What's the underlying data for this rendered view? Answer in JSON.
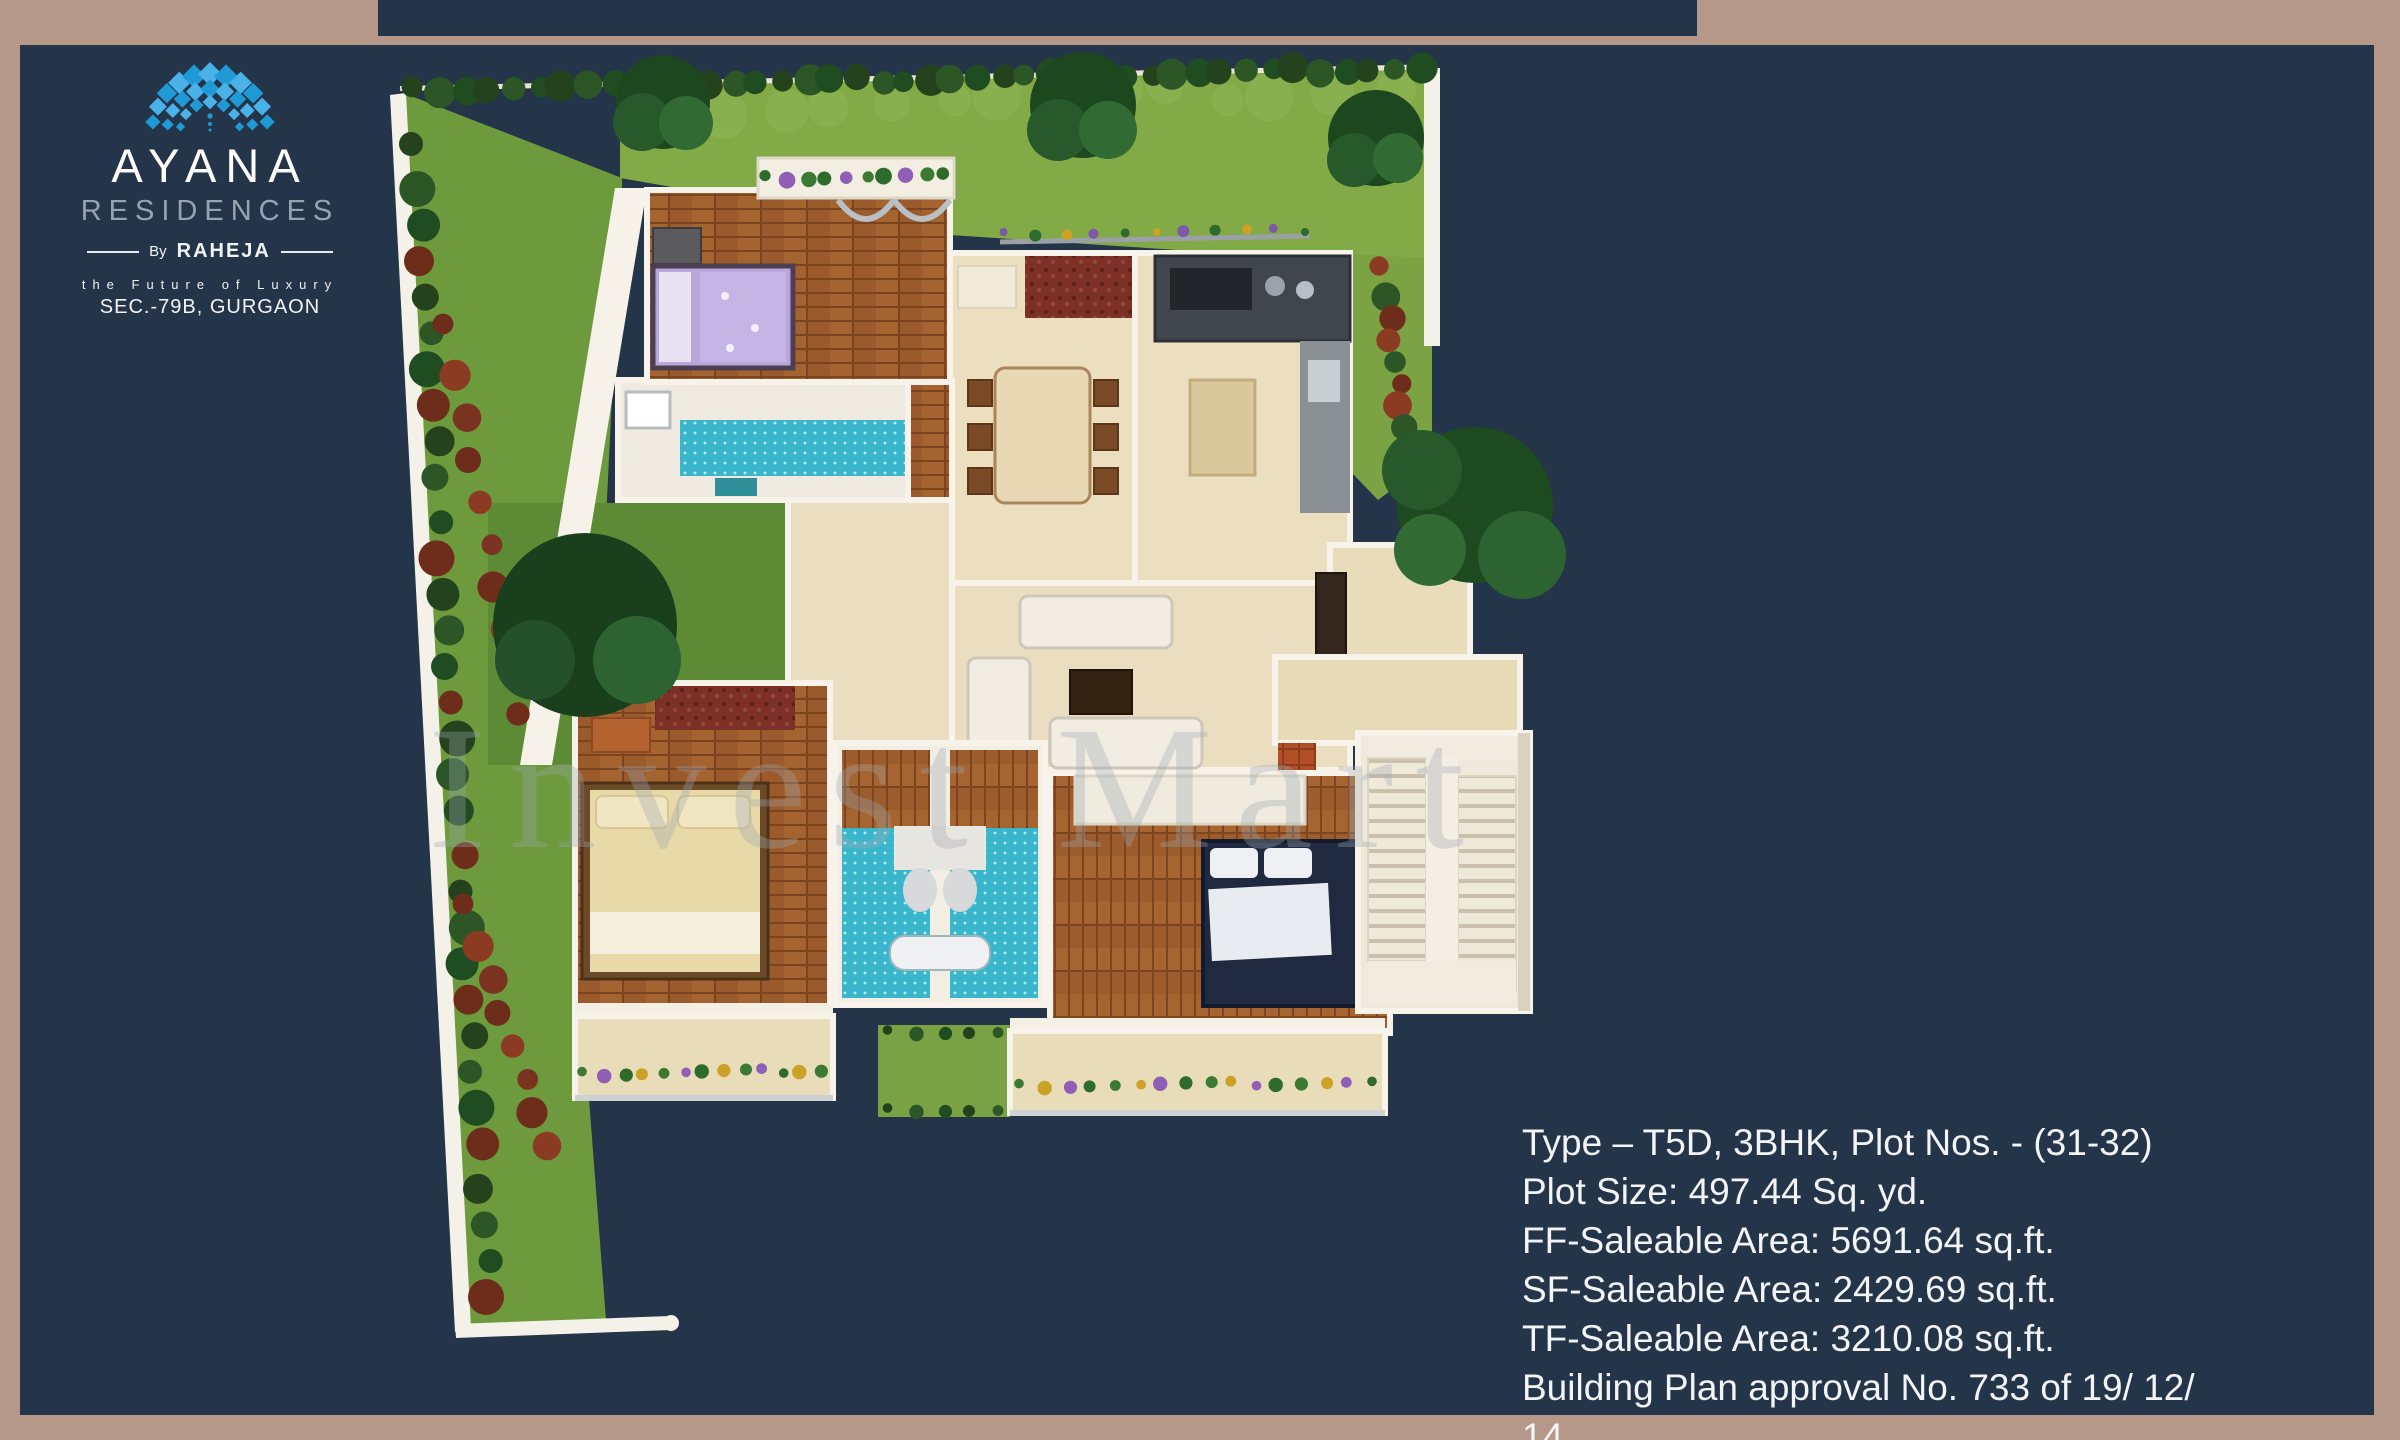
{
  "frame": {
    "border_color": "#b59889",
    "background_color": "#243449"
  },
  "logo": {
    "brand": "AYANA",
    "subbrand": "RESIDENCES",
    "by": "By",
    "developer": "RAHEJA",
    "tagline": "the Future of Luxury",
    "location": "SEC.-79B, GURGAON",
    "arch_color": "#1f9ad6",
    "brand_color": "#fdfdfd",
    "subbrand_color": "#97a3b0"
  },
  "watermark": {
    "text": "Invest Mart"
  },
  "details": {
    "lines": [
      "Type – T5D, 3BHK, Plot Nos. - (31-32)",
      "Plot Size: 497.44 Sq. yd.",
      "FF-Saleable Area: 5691.64 sq.ft.",
      "SF-Saleable Area: 2429.69 sq.ft.",
      "TF-Saleable Area: 3210.08 sq.ft.",
      "Building Plan approval No. 733 of 19/ 12/ 14"
    ],
    "text_color": "#f2f4f6"
  },
  "floor_plan": {
    "description": "3D isometric first-floor plan of a 3BHK villa with garden strip, three bedrooms, three bathrooms, kitchen, dining, living room, foyer, staircase and planted balconies",
    "depicted_rooms": [
      "bedroom",
      "bathroom",
      "dining",
      "kitchen",
      "living-room",
      "foyer",
      "bedroom",
      "bathroom",
      "bathroom",
      "bedroom",
      "staircase",
      "balcony",
      "garden",
      "courtyard"
    ],
    "palette": {
      "lawn": "#6d9a3c",
      "bright_lawn": "#82aa47",
      "hedge": "#24431d",
      "shrub": "#7a3320",
      "wood_floor": "#9a5a2b",
      "cream_floor": "#ebdec0",
      "tile_blue": "#3ab6cc",
      "wall_white": "#f6f2e9",
      "counter_dark": "#41464d"
    }
  }
}
